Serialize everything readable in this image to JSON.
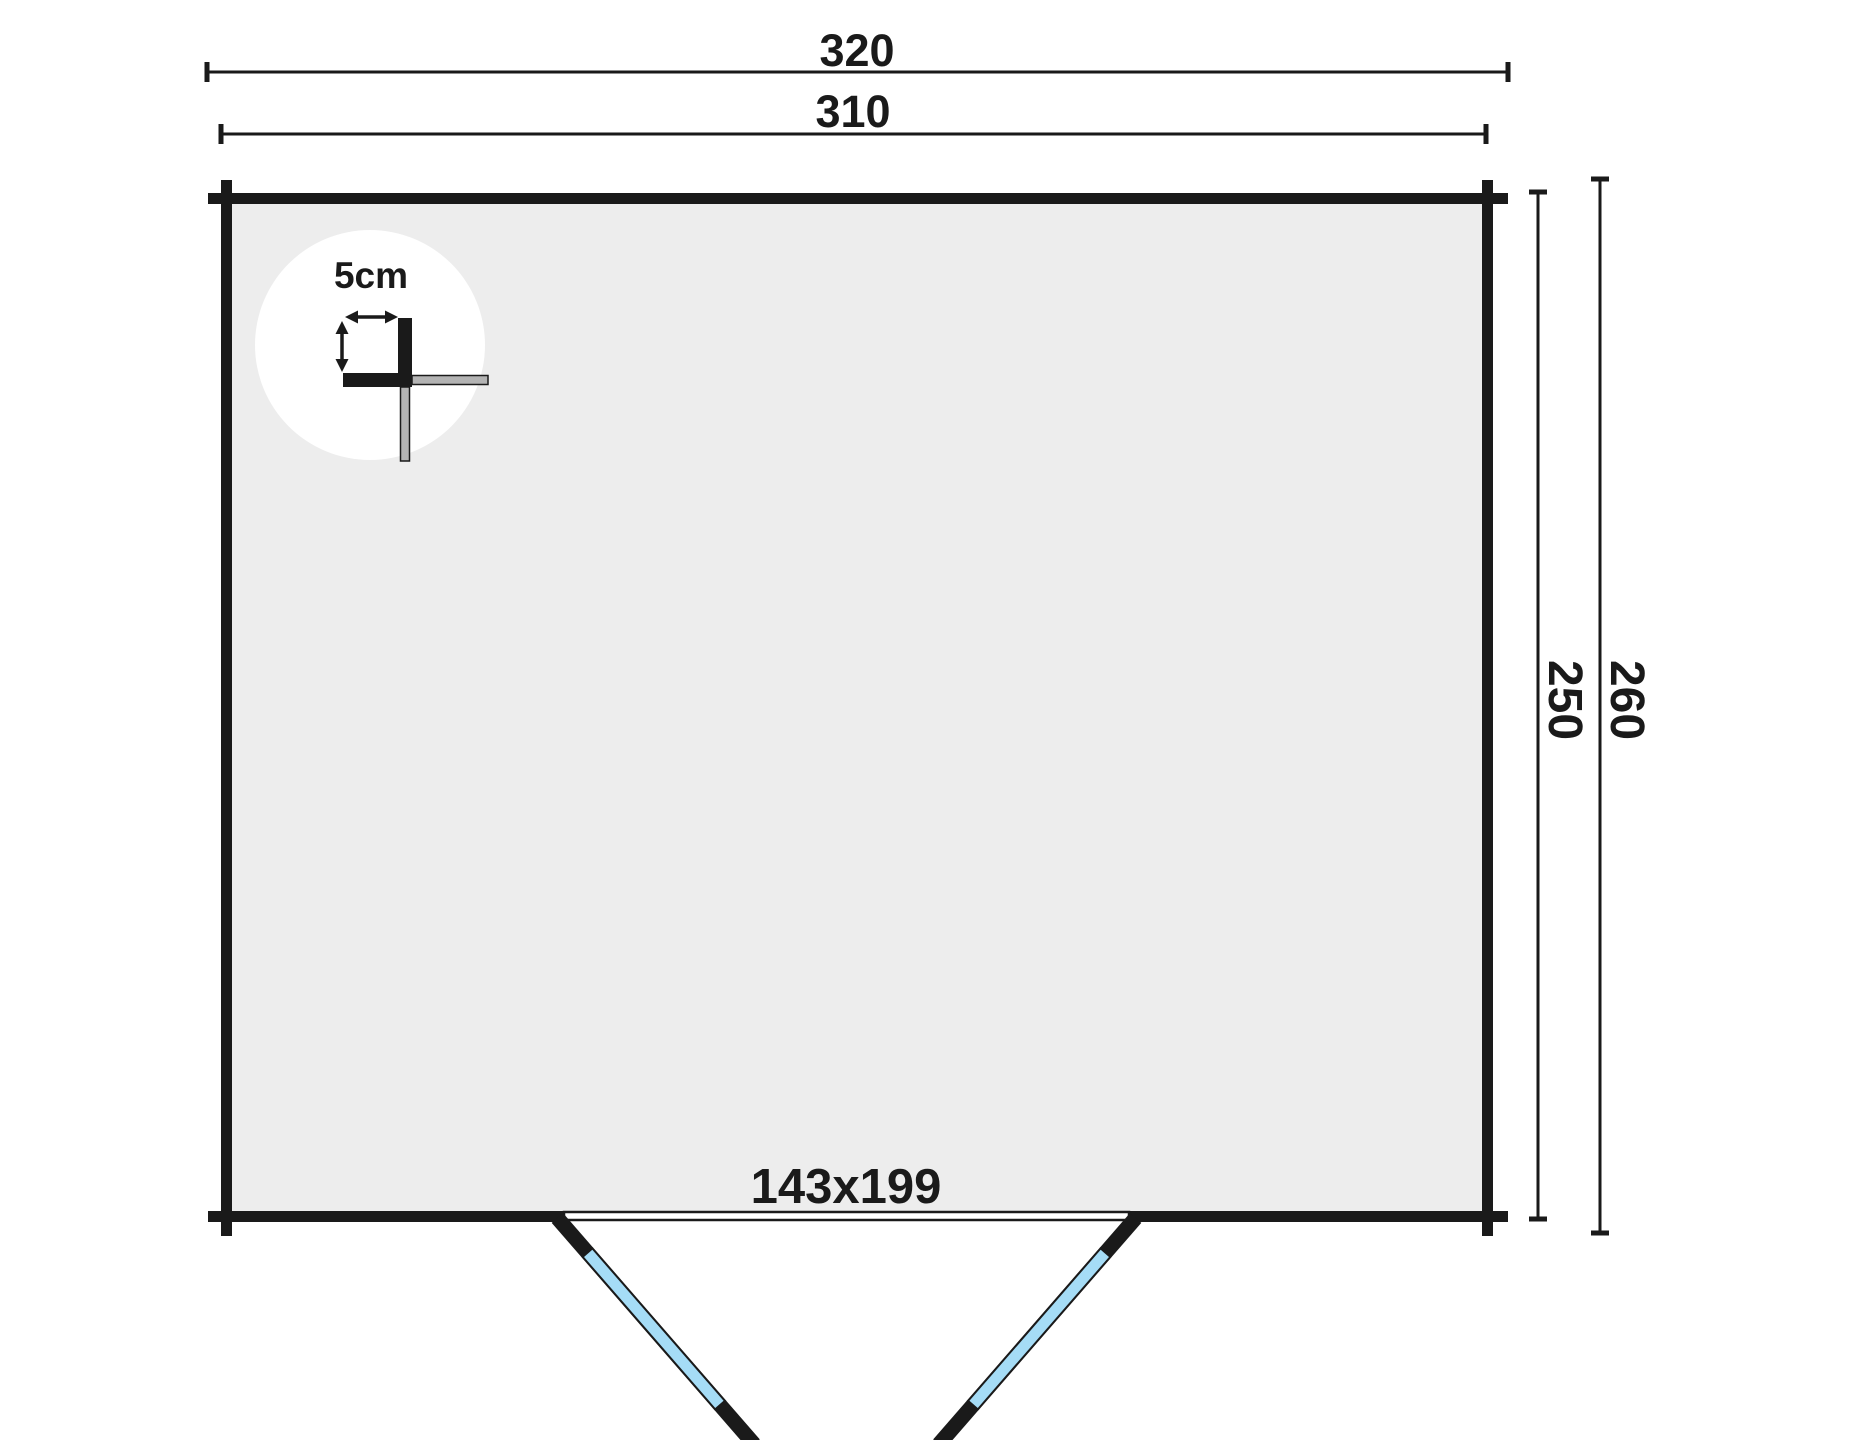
{
  "floorplan": {
    "dim_outer_width": "320",
    "dim_inner_width": "310",
    "dim_inner_height": "250",
    "dim_outer_height": "260",
    "door_label": "143x199",
    "detail_label": "5cm",
    "colors": {
      "wall": "#1a1a1a",
      "interior": "#ededed",
      "detail_circle": "#ffffff",
      "log_gray": "#b3b3b3",
      "door_glass": "#a5dcf6",
      "background": "#ffffff"
    }
  }
}
